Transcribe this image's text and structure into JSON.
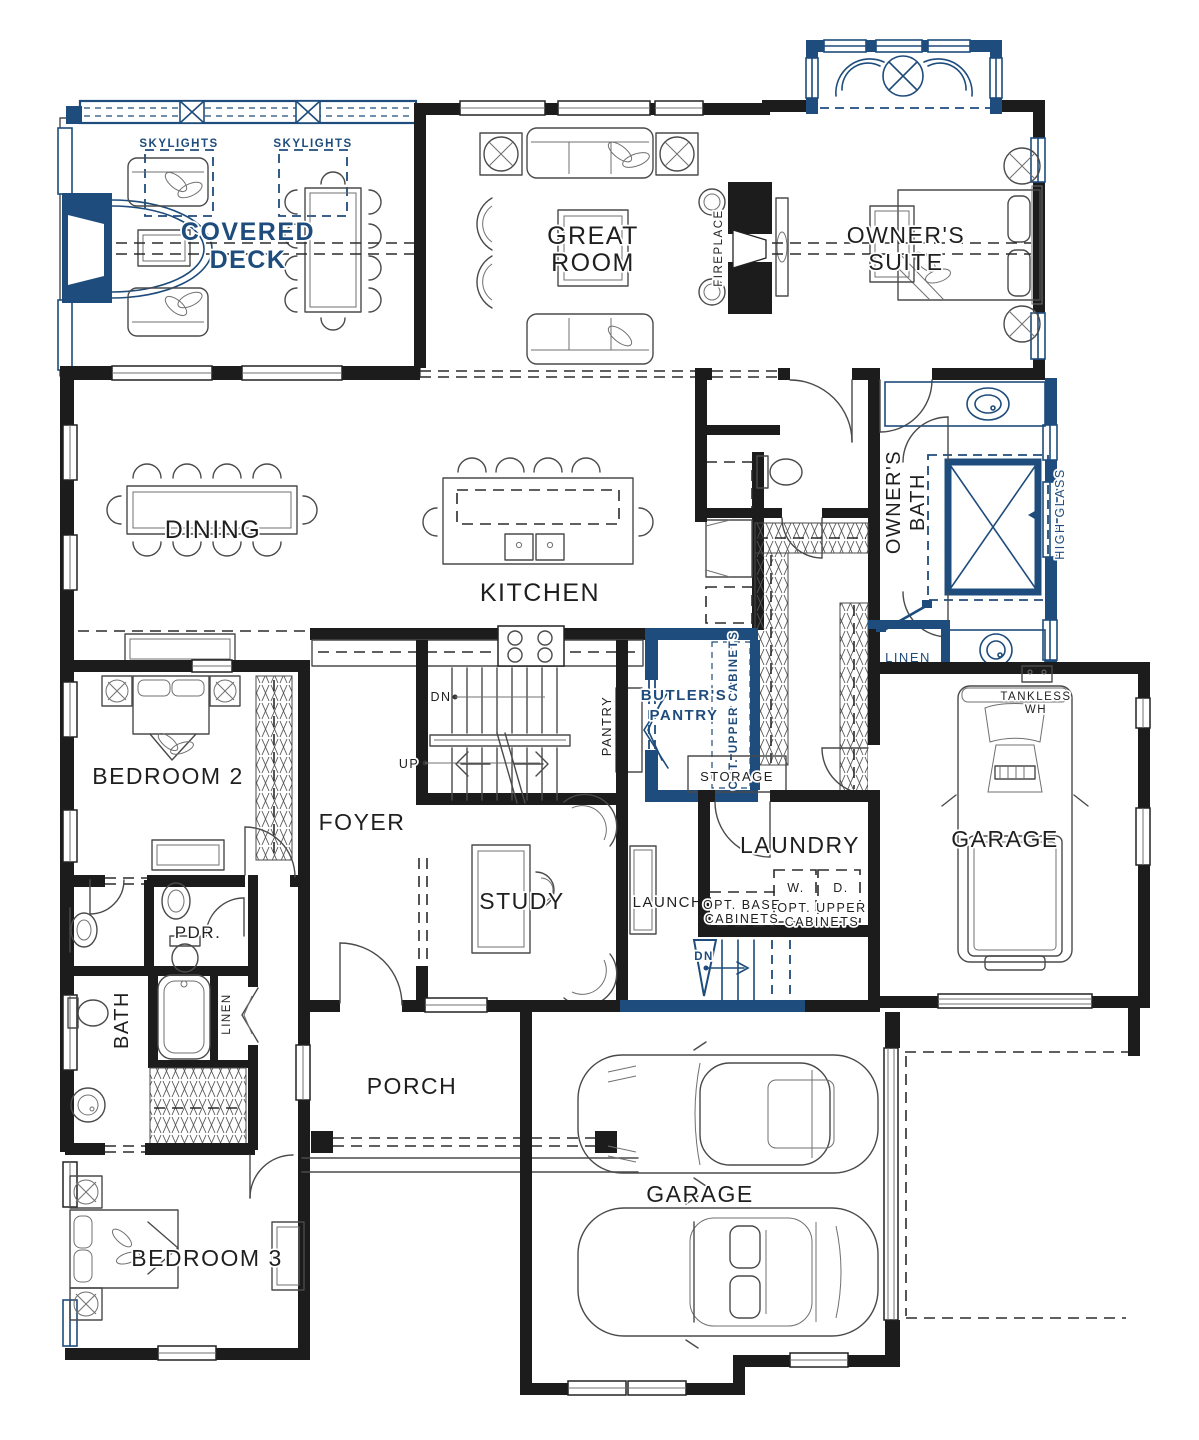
{
  "colors": {
    "wall": "#1c1c1c",
    "accent_blue": "#1e4c7c",
    "furniture_line": "#4a4a4a"
  },
  "labels": {
    "skylights": "SKYLIGHTS",
    "covered_deck": {
      "line1": "COVERED",
      "line2": "DECK"
    },
    "great_room": {
      "line1": "GREAT",
      "line2": "ROOM"
    },
    "fireplace": "FIREPLACE",
    "owners_suite": {
      "line1": "OWNER'S",
      "line2": "SUITE"
    },
    "dining": "DINING",
    "kitchen": "KITCHEN",
    "owners_bath": {
      "line1": "OWNER'S",
      "line2": "BATH"
    },
    "high_glass": "HIGH GLASS",
    "linen_owners": "LINEN",
    "tankless_wh": {
      "line1": "TANKLESS",
      "line2": "WH"
    },
    "bedroom_2": "BEDROOM 2",
    "foyer": "FOYER",
    "pantry": "PANTRY",
    "butlers_pantry": {
      "line1": "BUTLER'S",
      "line2": "PANTRY"
    },
    "opt_upper_cabinets_vert": "OPT. UPPER CABINETS",
    "storage": "STORAGE",
    "laundry": "LAUNDRY",
    "launch": "LAUNCH",
    "opt_base_cabinets": {
      "line1": "OPT. BASE",
      "line2": "CABINETS"
    },
    "opt_upper_cabinets": {
      "line1": "OPT. UPPER",
      "line2": "CABINETS"
    },
    "washer": "W.",
    "dryer": "D.",
    "garage_side": "GARAGE",
    "garage_main": "GARAGE",
    "pdr": "PDR.",
    "bath": "BATH",
    "linen_hall": "LINEN",
    "study": "STUDY",
    "porch": "PORCH",
    "bedroom_3": "BEDROOM 3",
    "dn_stairs": "DN",
    "up_stairs": "UP",
    "dn_basement": "DN"
  }
}
